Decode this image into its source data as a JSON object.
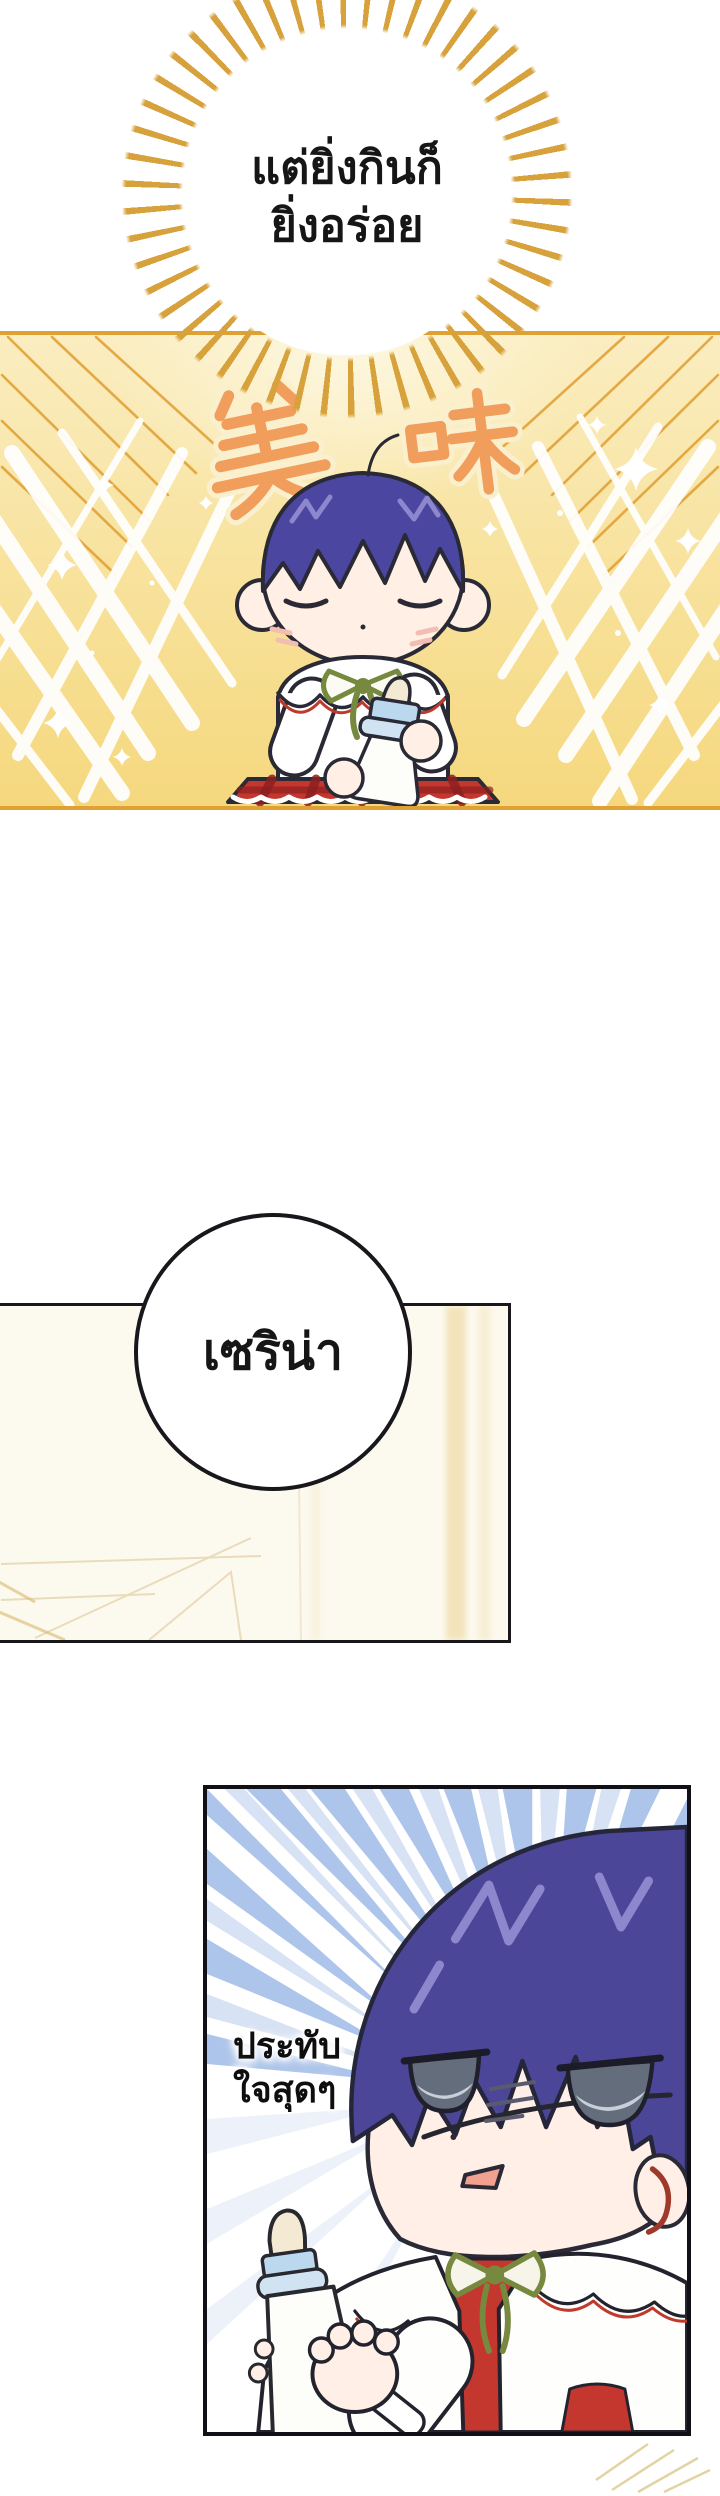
{
  "page": {
    "width": 720,
    "height": 2496,
    "background": "#FFFFFF",
    "kind": "webtoon-comic-page"
  },
  "top_burst_bubble": {
    "line1": "แต่ยิ่งกินก็",
    "line2": "ยิ่งอร่อย",
    "text_color": "#161616",
    "ray_color": "#D7A23B",
    "fill": "#FFFFFF"
  },
  "gold_panel": {
    "sfx_text": "美味",
    "sfx_fill": "#F19E5C",
    "sfx_outline": "#FBF0CE",
    "bg_top": "#FAEDC0",
    "bg_bottom": "#F5D87E",
    "edge_line_color": "#DFA133",
    "streak_color": "#FFFFFF",
    "sparkle_color": "#FFFFFF",
    "baby": {
      "hair": "#4B46A0",
      "hair_highlight": "#8D87CE",
      "skin": "#FFEFE4",
      "outline": "#2A2A36",
      "top": "#FFFFFF",
      "collar_trim": "#C03A2C",
      "bow": "#77883F",
      "skirt": "#C4372F",
      "skirt_dark": "#8E1F1F",
      "bottle_body": "#FDFDFA",
      "bottle_band": "#BCD8EF",
      "bottle_ring": "#CFE3F3",
      "bottle_nipple": "#F4E9D2"
    }
  },
  "middle_panel": {
    "bubble_text": "เซริน่า",
    "bubble_fill": "#FFFFFF",
    "bubble_border": "#17171C",
    "bg": "#FCF9EE",
    "accent_stripe": "#EBD394",
    "border": "#17171C"
  },
  "bottom_panel": {
    "caption_line1": "ประทับ",
    "caption_line2": "ใจสุดๆ",
    "caption_color": "#0E0E0E",
    "speed_line_color": "#A9C2E9",
    "speed_line_light": "#D3DFF3",
    "border": "#101016",
    "baby": {
      "hair": "#4B4697",
      "hair_highlight": "#8D87CE",
      "skin": "#FFEFE6",
      "eye_iris": "#646D7B",
      "eye_light": "#C8CFDA",
      "mouth": "#F2A08F",
      "ear_inner": "#9E392C",
      "capelet": "#FEFEFC",
      "capelet_trim": "#C03A2C",
      "bow": "#77883F",
      "garment": "#C4372F",
      "bottle_body": "#FDFDFA",
      "bottle_band": "#BCD8EF",
      "bottle_ring": "#CFE3F3",
      "bottle_nipple": "#F4E9D2"
    }
  },
  "footer_sparkle_color": "#DDC98E"
}
